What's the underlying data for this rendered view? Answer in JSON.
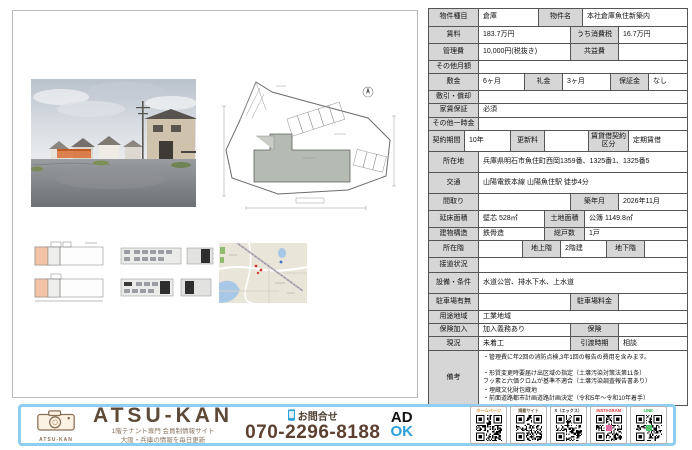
{
  "colors": {
    "label_bg": "#d6d6d6",
    "footer_border": "#8ecef0",
    "brand_brown": "#5d4a37",
    "phone_brown": "#5d4030",
    "ok_blue": "#2b9fd8"
  },
  "table": {
    "rows": [
      {
        "h": 17,
        "cells": [
          {
            "t": "label",
            "w": 50,
            "text": "物件種目"
          },
          {
            "t": "value",
            "w": 60,
            "text": "倉庫"
          },
          {
            "t": "label",
            "w": 44,
            "text": "物件名"
          },
          {
            "t": "value",
            "text": "本社倉庫魚住新築内"
          }
        ]
      },
      {
        "h": 16,
        "cells": [
          {
            "t": "label",
            "w": 50,
            "text": "賃料"
          },
          {
            "t": "value",
            "w": 92,
            "text": "183.7万円"
          },
          {
            "t": "label",
            "w": 48,
            "text": "うち消費税"
          },
          {
            "t": "value",
            "text": "16.7万円"
          }
        ]
      },
      {
        "h": 16,
        "cells": [
          {
            "t": "label",
            "w": 50,
            "text": "管理費"
          },
          {
            "t": "value",
            "w": 92,
            "text": "10,000円(税抜き)"
          },
          {
            "t": "label",
            "w": 48,
            "text": "共益費"
          },
          {
            "t": "value",
            "text": ""
          }
        ]
      },
      {
        "h": 12,
        "cells": [
          {
            "t": "label",
            "w": 50,
            "text": "その他月額"
          },
          {
            "t": "value",
            "text": ""
          }
        ]
      },
      {
        "h": 16,
        "cells": [
          {
            "t": "label",
            "w": 50,
            "text": "敷金"
          },
          {
            "t": "value",
            "w": 46,
            "text": "6ヶ月"
          },
          {
            "t": "label",
            "w": 38,
            "text": "礼金"
          },
          {
            "t": "value",
            "w": 48,
            "text": "3ヶ月"
          },
          {
            "t": "label",
            "w": 38,
            "text": "保証金"
          },
          {
            "t": "value",
            "text": "なし"
          }
        ]
      },
      {
        "h": 12,
        "cells": [
          {
            "t": "label",
            "w": 50,
            "text": "敷引・償却"
          },
          {
            "t": "value",
            "text": ""
          }
        ]
      },
      {
        "h": 13,
        "cells": [
          {
            "t": "label",
            "w": 50,
            "text": "家賃保証"
          },
          {
            "t": "value",
            "text": "必須"
          }
        ]
      },
      {
        "h": 12,
        "cells": [
          {
            "t": "label",
            "w": 50,
            "text": "その他一時金"
          },
          {
            "t": "value",
            "text": ""
          }
        ]
      },
      {
        "h": 20,
        "cells": [
          {
            "t": "label",
            "w": 36,
            "text": "契約期間"
          },
          {
            "t": "value",
            "w": 46,
            "text": "10年"
          },
          {
            "t": "label",
            "w": 34,
            "text": "更新料"
          },
          {
            "t": "value",
            "w": 44,
            "text": ""
          },
          {
            "t": "label",
            "w": 40,
            "text": "賃貸借契約区分"
          },
          {
            "t": "value",
            "text": "定期賃借"
          }
        ]
      },
      {
        "h": 20,
        "cells": [
          {
            "t": "label",
            "w": 50,
            "text": "所在地"
          },
          {
            "t": "value",
            "text": "兵庫県明石市魚住町西岡1359番、1325番1、1325番5"
          }
        ]
      },
      {
        "h": 20,
        "cells": [
          {
            "t": "label",
            "w": 50,
            "text": "交通"
          },
          {
            "t": "value",
            "text": "山陽電鉄本線 山陽魚住駅 徒歩4分"
          }
        ]
      },
      {
        "h": 16,
        "cells": [
          {
            "t": "label",
            "w": 50,
            "text": "間取り"
          },
          {
            "t": "value",
            "w": 92,
            "text": ""
          },
          {
            "t": "label",
            "w": 48,
            "text": "築年月"
          },
          {
            "t": "value",
            "text": "2026年11月"
          }
        ]
      },
      {
        "h": 16,
        "cells": [
          {
            "t": "label",
            "w": 50,
            "text": "延床面積"
          },
          {
            "t": "value",
            "w": 66,
            "text": "壁芯 528㎡"
          },
          {
            "t": "label",
            "w": 40,
            "text": "土地面積"
          },
          {
            "t": "value",
            "text": "公簿 1149.8㎡"
          }
        ]
      },
      {
        "h": 12,
        "cells": [
          {
            "t": "label",
            "w": 50,
            "text": "建物構造"
          },
          {
            "t": "value",
            "w": 66,
            "text": "鉄骨造"
          },
          {
            "t": "label",
            "w": 40,
            "text": "総戸数"
          },
          {
            "t": "value",
            "text": "1戸"
          }
        ]
      },
      {
        "h": 16,
        "cells": [
          {
            "t": "label",
            "w": 50,
            "text": "所在階"
          },
          {
            "t": "value",
            "w": 44,
            "text": ""
          },
          {
            "t": "label",
            "w": 38,
            "text": "地上階"
          },
          {
            "t": "value",
            "w": 46,
            "text": "2階建"
          },
          {
            "t": "label",
            "w": 38,
            "text": "地下階"
          },
          {
            "t": "value",
            "text": ""
          }
        ]
      },
      {
        "h": 14,
        "cells": [
          {
            "t": "label",
            "w": 50,
            "text": "接道状況"
          },
          {
            "t": "value",
            "text": ""
          }
        ]
      },
      {
        "h": 20,
        "cells": [
          {
            "t": "label",
            "w": 50,
            "text": "設備・条件"
          },
          {
            "t": "value",
            "text": "水道公営、排水下水、上水道"
          }
        ]
      },
      {
        "h": 16,
        "cells": [
          {
            "t": "label",
            "w": 50,
            "text": "駐車場有無"
          },
          {
            "t": "value",
            "w": 92,
            "text": ""
          },
          {
            "t": "label",
            "w": 48,
            "text": "駐車場料金"
          },
          {
            "t": "value",
            "text": ""
          }
        ]
      },
      {
        "h": 12,
        "cells": [
          {
            "t": "label",
            "w": 50,
            "text": "用途地域"
          },
          {
            "t": "value",
            "text": "工業地域"
          }
        ]
      },
      {
        "h": 12,
        "cells": [
          {
            "t": "label",
            "w": 50,
            "text": "保険加入"
          },
          {
            "t": "value",
            "w": 92,
            "text": "加入義務あり"
          },
          {
            "t": "label",
            "w": 48,
            "text": "保険"
          },
          {
            "t": "value",
            "text": ""
          }
        ]
      },
      {
        "h": 13,
        "cells": [
          {
            "t": "label",
            "w": 50,
            "text": "現況"
          },
          {
            "t": "value",
            "w": 92,
            "text": "未着工"
          },
          {
            "t": "label",
            "w": 48,
            "text": "引渡時期"
          },
          {
            "t": "value",
            "text": "相談"
          }
        ]
      },
      {
        "h": 48,
        "cells": [
          {
            "t": "label",
            "w": 50,
            "text": "備考"
          },
          {
            "t": "value",
            "small": true,
            "text": [
              "・管理費に年2回の消防点検,3年1回の報告の費用を含みます。",
              "",
              "・形質変更時要届け出区域の指定（土壌汚染対策法第11条）",
              "フッ素と六価クロムが基準不適合（土壌汚染調査報告書あり）",
              "・埋蔵文化財包蔵地",
              "・前面道路都市計画道路計画決定（令和5年～令和10年着手）"
            ]
          }
        ]
      }
    ]
  },
  "footer": {
    "logo_caption": "ATSU-KAN",
    "brand": "ATSU-KAN",
    "tagline_line1": "1階テナント専門 会員制情報サイト",
    "tagline_line2": "大阪・兵庫の情報を毎日更新",
    "contact_label": "お問合せ",
    "phone": "070-2296-8188",
    "ad_text": "AD",
    "ok_text": "OK",
    "qr_links": [
      {
        "label": "ホームページ",
        "color": "#e8962e",
        "seed": 11
      },
      {
        "label": "掲載サイト",
        "color": "#6b5b3e",
        "seed": 23
      },
      {
        "label": "X（エックス）",
        "color": "#333333",
        "seed": 37
      },
      {
        "label": "INSTAGRAM",
        "color": "#e53935",
        "seed": 51,
        "center": "#e06ba0"
      },
      {
        "label": "LINE",
        "color": "#1fad3e",
        "seed": 67,
        "center": "#4fc46a"
      }
    ]
  }
}
